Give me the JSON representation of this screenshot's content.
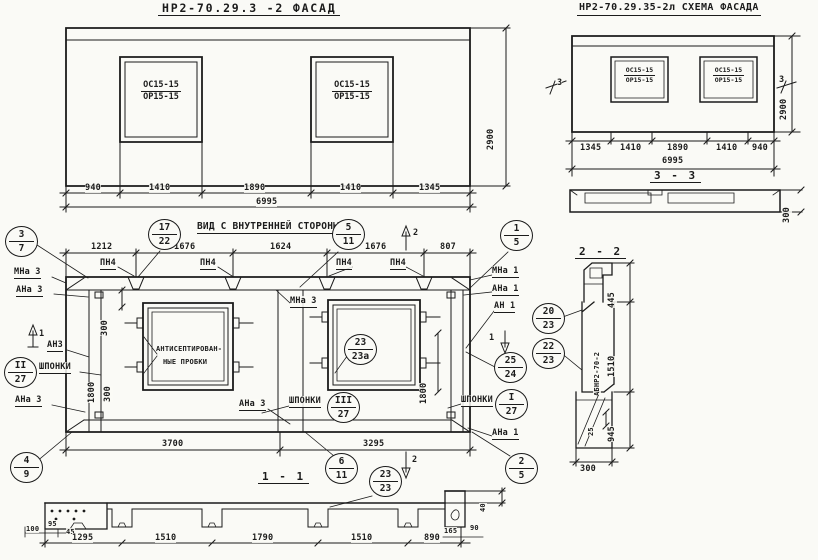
{
  "titles": {
    "facade": "НР2-70.29.3 -2  ФАСАД",
    "scheme": "НР2-70.29.35-2л СХЕМА ФАСАДА",
    "inner": "ВИД С ВНУТРЕННЕЙ СТОРОНЫ",
    "s11": "1 - 1",
    "s22": "2 - 2",
    "s33": "3 - 3"
  },
  "win": {
    "top": "ОС15-15",
    "bot": "ОР15-15"
  },
  "facade": {
    "d": [
      "940",
      "1410",
      "1890",
      "1410",
      "1345"
    ],
    "total": "6995",
    "h": "2900"
  },
  "scheme": {
    "d": [
      "1345",
      "1410",
      "1890",
      "1410",
      "940"
    ],
    "total": "6995",
    "h": "2900",
    "cut": "3",
    "profile_h": "300"
  },
  "inner": {
    "d_top": [
      "1212",
      "1676",
      "1624",
      "1676",
      "807"
    ],
    "pn": "ПН4",
    "mna3": "МНа 3",
    "ana3": "АНа 3",
    "an3": "АН3",
    "mna1": "МНа 1",
    "ana1": "АНа 1",
    "an1": "АН 1",
    "shponki": "ШПОНКИ",
    "note1": "АНТИСЕПТИРОВАН-",
    "note2": "НЫЕ ПРОБКИ",
    "d300": "300",
    "d1800": "1800",
    "d_bot": [
      "3700",
      "3295"
    ],
    "cut1": "1",
    "cut2": "2"
  },
  "s11": {
    "d": [
      "1295",
      "1510",
      "1790",
      "1510",
      "890"
    ],
    "small_l": [
      "100",
      "95",
      "45"
    ],
    "small_r": [
      "165",
      "90"
    ],
    "d40": "40"
  },
  "s22": {
    "mark": "АБНР2-70-2",
    "d445": "445",
    "d1510": "1510",
    "d25": "25",
    "d945": "945",
    "d300": "300"
  },
  "s33": {
    "d300": "300"
  },
  "markers": {
    "m3_7": [
      "3",
      "7"
    ],
    "m17_22": [
      "17",
      "22"
    ],
    "m5_11": [
      "5",
      "11"
    ],
    "m1_5": [
      "1",
      "5"
    ],
    "mII_27": [
      "II",
      "27"
    ],
    "m23_23a": [
      "23",
      "23а"
    ],
    "mIII_27": [
      "III",
      "27"
    ],
    "mI_27": [
      "I",
      "27"
    ],
    "m25_24": [
      "25",
      "24"
    ],
    "m4_9": [
      "4",
      "9"
    ],
    "m6_11": [
      "6",
      "11"
    ],
    "m2_5": [
      "2",
      "5"
    ],
    "m23_23": [
      "23",
      "23"
    ],
    "m20_23": [
      "20",
      "23"
    ],
    "m22_23": [
      "22",
      "23"
    ]
  }
}
